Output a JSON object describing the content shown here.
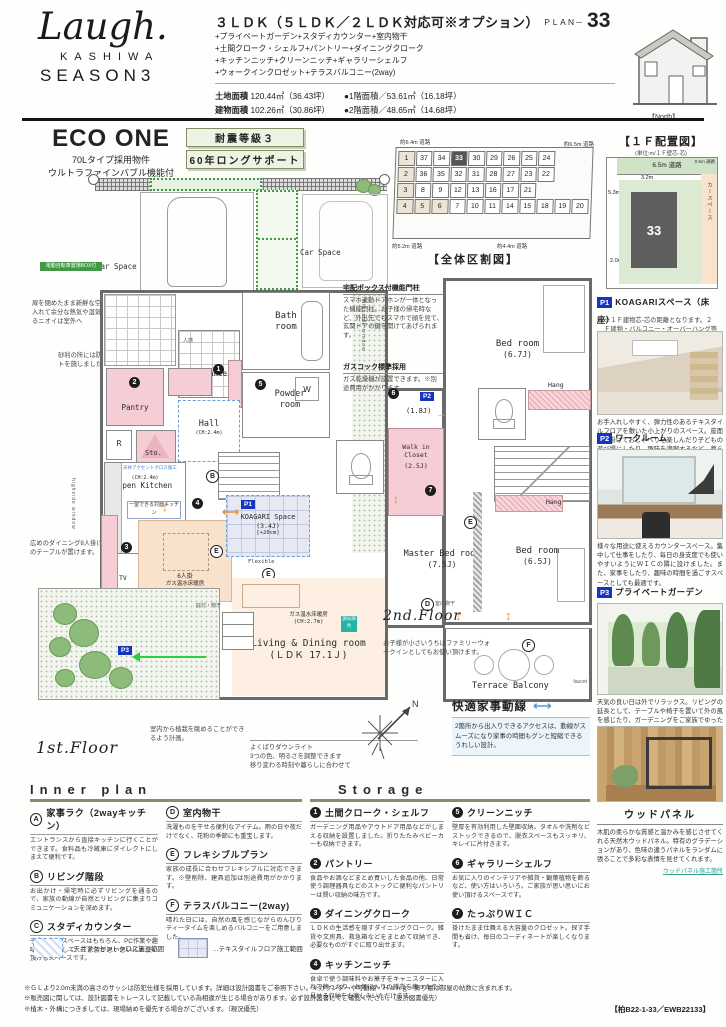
{
  "icons": {
    "h_arrow": "⟷",
    "v_arrow": "↕",
    "l_arrow": "←",
    "r_arrow": "→",
    "lr_arrow": "⟷"
  },
  "header": {
    "logo_script": "Laugh.",
    "logo_kashiwa": "KASHIWA",
    "logo_season": "SEASON3",
    "plan_type": "３ＬＤＫ（５ＬＤＫ／２ＬＤＫ対応可※オプション）",
    "plan_label": "ＰＬＡＮ－",
    "plan_number": "33",
    "features": [
      "+プライベートガーデン+スタディカウンター+室内物干",
      "+土間クローク・シェルフ+パントリー+ダイニングクローク",
      "+キッチンニッチ+クリーンニッチ+ギャラリーシェルフ",
      "+ウォークインクロゼット+テラスバルコニー(2way)"
    ],
    "land_label": "土地面積",
    "land_value": "120.44㎡（36.43坪）",
    "building_label": "建物面積",
    "building_value": "102.26㎡（30.86坪）",
    "floor1_area": "●1階面積／53.61㎡（16.18坪）",
    "floor2_area": "●2階面積／48.65㎡（14.68坪）",
    "north_label": "【North】"
  },
  "eco": {
    "title": "ECO ONE",
    "line1": "70Lタイプ採用物件",
    "line2": "ウルトラファインバブル機能付",
    "badge1": "耐震等級３",
    "badge2": "60年ロングサポート"
  },
  "sitemap": {
    "caption": "【全体区割図】",
    "road_top_left": "約6.4m 道路",
    "road_top_right": "約6.5m 道路",
    "road_bottom_left": "約5.2m 道路",
    "road_bottom_right": "約4.4m 道路",
    "highlight": "33",
    "shaded": [
      "1",
      "2",
      "3",
      "4",
      "5",
      "6"
    ],
    "rows": [
      [
        "1",
        "37",
        "34",
        "33",
        "30",
        "29",
        "26",
        "25",
        "24"
      ],
      [
        "2",
        "36",
        "35",
        "32",
        "31",
        "28",
        "27",
        "23",
        "22"
      ],
      [
        "3",
        "8",
        "9",
        "12",
        "13",
        "16",
        "17",
        "21"
      ],
      [
        "4",
        "5",
        "6",
        "7",
        "10",
        "11",
        "14",
        "15",
        "18",
        "19",
        "20"
      ]
    ]
  },
  "layout1f": {
    "title": "【１Ｆ配置図】",
    "unit": "(単位:m/１Ｆ壁芯-芯)",
    "road": "6.5m 道路",
    "path": "0.6m 通路",
    "dim_top": "3.2m",
    "dim_left1": "5.3m",
    "dim_left2": "2.9m",
    "dim_left3": "2.0m",
    "dim_bottom": "2.9m",
    "lot": "33",
    "car": "カースペース",
    "note": "※１Ｆ建物芯-芯の距離となります。２Ｆ建物・バルコニー・オーバーハング等は表記されておりません。"
  },
  "plan1": {
    "floor_label": "1st.Floor",
    "car1": "Car Space",
    "car2": "Car Space",
    "bike": "電動自転車置場BOX付",
    "rooms": {
      "bath": "Bath\nroom",
      "powder": "Powder\nroom",
      "entrance": "Entrance",
      "hall": "Hall",
      "hall_ch": "(CH:2.4m)",
      "pantry": "Pantry",
      "sto": "Sto.",
      "r": "R",
      "w": "W",
      "kitchen": "Open Kitchen",
      "kitchen_ch": "(CH:2.4m)",
      "kitchen_note": "一望できる対面キッチン",
      "tv": "TV",
      "seat": "6人掛",
      "yuka1": "ガス温水床暖房",
      "yuka2": "ガス温水床暖房",
      "koagari": "KOAGARI Space",
      "koagari_j": "(3.4J)",
      "koagari_step": "[+20cm]",
      "flexible": "Flexible",
      "living1": "Living & Dining room",
      "living2": "(ＬＤＫ 17.1Ｊ)",
      "living_ch": "(CH:2.7m)",
      "chip": "調光調色",
      "porch": "庇付・物干",
      "highside_r": "highside window",
      "highside_l": "highside window",
      "p1": "P1",
      "p3": "P3",
      "jinkan": "人感"
    },
    "ann_vent": "扉を閉めたまま新鮮な空気を取り入れて余分な熱気や湿気、気になるニオイは室外へ",
    "ann_gravel": "砂利の所には防草シートを施しました。",
    "ann_dining": "広めのダイニング8人掛けサイズのテーブルが置けます。",
    "ann_plants": "室内から植栽を眺めることができるよう計画。",
    "ann_light1": "よくばりダウンライト",
    "ann_light2": "3つの色、明るさを調整できます",
    "ann_light3": "移り変わる時刻や暮らしに合わせて",
    "ceiling_note": "天井アクセントクロス施工"
  },
  "plan2": {
    "floor_label": "2nd.Floor",
    "rooms": {
      "bed67": "Bed room",
      "bed67_j": "(6.7J)",
      "work_j": "(1.8J)",
      "wic1": "Walk in",
      "wic2": "Closet",
      "wic_j": "(2.5J)",
      "master": "Master Bed room",
      "master_j": "(7.5J)",
      "bed65": "Bed room",
      "bed65_j": "(6.5J)",
      "terrace": "Terrace Balcony",
      "hang1": "Hang",
      "hang2": "Hang",
      "faucet": "faucet",
      "monohoshi": "室内物干",
      "p2": "P2"
    },
    "ann_post_title": "宅配ボックス付機能門柱",
    "ann_post_body": "スマホ連動ドアホンが一体となった機能門柱。お子様の帰宅時など、外出先でもスマホで顔を見て、玄関ドアの鍵を開けてあげられます。",
    "ann_gas_title": "ガスコック標準採用",
    "ann_gas_body": "ガス乾燥機が設置できます。※別途費用がかかります。",
    "ann_wic": "お子様が小さいうちはファミリーウォークインとしてもお使い頂けます。",
    "flow_title": "快適家事動線",
    "flow_body": "2箇所から出入りできるアクセスは、動線がスムーズになり家事の時間もグンと短縮できるうれしい設計。",
    "compass_n": "N"
  },
  "plan_badges": {
    "n1": "1",
    "n2": "2",
    "n3": "3",
    "n4": "4",
    "n5": "5",
    "n6": "6",
    "n7": "7",
    "a": "A",
    "b": "B",
    "c": "C",
    "d": "D",
    "e1": "E",
    "e2": "E",
    "e3": "E",
    "f": "F"
  },
  "photos": [
    {
      "tag": "P1",
      "title": "KOAGARIスペース（床座）",
      "body": "お手入れしやすく、弾力性のあるテキスタイルフロアを敷いた小上がりのスペース。座面に腰掛けておしゃべりを楽しんだり子どもの遊び場にしたり、趣味を満喫するなど、暮らしの楽しみが広がります。"
    },
    {
      "tag": "P2",
      "title": "ワークルーム",
      "body": "様々な用途に使えるカウンタースペース。集中して仕事をしたり、毎日の身支度でも使いやすいようにＷＩＣの隣に設けました。また、家事をしたり、趣味の時間を過ごすスペースとしても最適です。"
    },
    {
      "tag": "P3",
      "title": "プライベートガーデン",
      "body": "天気の良い日は外でリラックス。リビングの延長として、テーブルや椅子を置いて外の風を感じたり、ガーデニングをご家族でゆったり楽しめます。"
    },
    {
      "tag": "",
      "title": "ウッドパネル",
      "body": "木肌の柔らかな質感と温かみを感じさせてくれる天然木ウッドパネル。特有のグラデーションがあり、色味の違うパネルをランダムに張ることで多彩な表情を見せてくれます。",
      "link": "ウッドパネル施工箇所"
    }
  ],
  "inner_plan": {
    "title": "Inner plan",
    "items": [
      {
        "key": "A",
        "title": "家事ラク（2wayキッチン）",
        "body": "エントランスから直接キッチンに行くことができます。食料品も冷蔵庫にダイレクトにしまえて便利です。"
      },
      {
        "key": "B",
        "title": "リビング階段",
        "body": "お出かけ・帰宅時に必ずリビングを通るので、家族の動線が自然とリビングに集まりコミュニケーションを深めます。"
      },
      {
        "key": "C",
        "title": "スタディカウンター",
        "body": "子供の勉強スペースはもちろん、PC作業や趣味の場所として、ご家族が思い思いにお使い頂けるスペースです。"
      },
      {
        "key": "D",
        "title": "室内物干",
        "body": "洗濯ものを干せる便利なアイテム。雨の日や夜だけでなく、花粉の季節にも重宝します。"
      },
      {
        "key": "E",
        "title": "フレキシブルプラン",
        "body": "家族の成長に合わせフレキシブルに対応できます。※壁削除、建具追加は別途費用がかかります。"
      },
      {
        "key": "F",
        "title": "テラスバルコニー(2way)",
        "body": "晴れた日には、自然の風を感じながらのんびりティータイムを楽しめるバルコニーをご用意しました。"
      }
    ],
    "legend1": "…天井アクセントクロス施工範囲",
    "legend2": "…テキスタイルフロア施工範囲"
  },
  "storage": {
    "title": "Storage",
    "items": [
      {
        "num": "1",
        "title": "土間クローク・シェルフ",
        "body": "ガーデニング用品やアウトドア用品などがしまえる収納を設置しました。折りたたみベビーカーも収納できます。"
      },
      {
        "num": "2",
        "title": "パントリー",
        "body": "食品やお酒などまとめ買いした食品の他、日常使う調理器具などのストックに便利なパントリーは賢い収納の味方です。"
      },
      {
        "num": "3",
        "title": "ダイニングクローク",
        "body": "ＬＤＫの生活感を隠すダイニングクローク。雑貨や文房具、救急箱などをまとめて収納でき、必要なものがすぐに取り出せます。"
      },
      {
        "num": "4",
        "title": "キッチンニッチ",
        "body": "食卓で使う調味料やお菓子をキャニスターに入れて飾ったり、お気に入りの雑貨を飾ったりと見せる収納をお楽しみいただけます。"
      },
      {
        "num": "5",
        "title": "クリーンニッチ",
        "body": "壁厚を有効利用した壁面収納。タオルや洗剤などストックできるので、脱衣スペースもスッキリ、キレイに片付きます。"
      },
      {
        "num": "6",
        "title": "ギャラリーシェルフ",
        "body": "お気に入りのインテリアや雑貨・観葉植物を飾るなど、使い方はいろいろ。ご家族が思い思いにお使い頂けるスペースです。"
      },
      {
        "num": "7",
        "title": "たっぷりＷＩＣ",
        "body": "掛けたまま仕舞える大容量のクロゼット。探す手間も省け、毎日のコーディネートが楽しくなります。"
      }
    ]
  },
  "footer": {
    "note1": "※ＧＬより2.0m未満の高さのサッシは防犯仕様を採用しています。詳細は設計図書をご参照下さい。※カウンターや可動棚・Ｈａｎｇ・飾り棚は部屋の帖数に含まれます。",
    "note2": "※販売図に関しては、設計図書をトレースして記載している為相違が生じる場合があります。必ず設計図書にてご確認ください。（設計図書優先）",
    "note3": "※植木・外構につきましては、現場納めを優先する場合がございます。（現況優先）",
    "code": "【柏B22-1-33／EWB22133】"
  }
}
